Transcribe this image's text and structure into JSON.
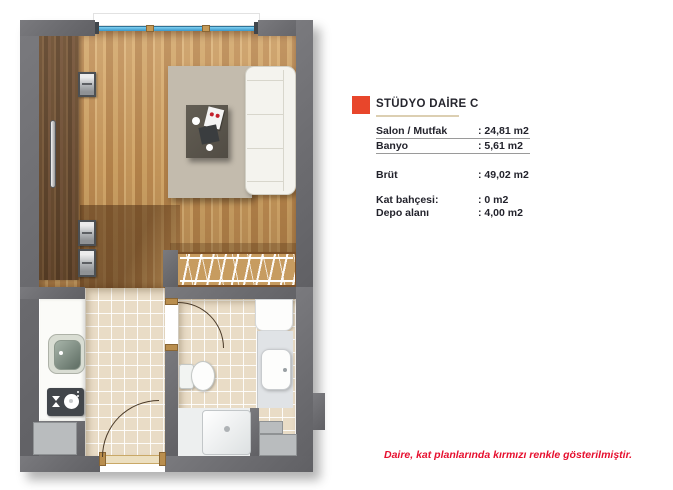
{
  "legend": {
    "marker_color": "#e8462b",
    "title": "STÜDYO DAİRE C",
    "rows": [
      {
        "label": "Salon / Mutfak",
        "value": ": 24,81 m2"
      },
      {
        "label": "Banyo",
        "value": ": 5,61 m2"
      },
      {
        "label": "Brüt",
        "value": ": 49,02 m2"
      },
      {
        "label": "Kat bahçesi:",
        "value": ": 0 m2"
      },
      {
        "label": "Depo alanı",
        "value": ": 4,00 m2"
      }
    ],
    "note": "Daire, kat planlarında kırmızı renkle gösterilmiştir."
  },
  "floorplan": {
    "colors": {
      "wall_gray": "#6b6b6f",
      "wood_light": "#c9995c",
      "wood_dark": "#6b4c2e",
      "tile_beige": "#e9dcc6",
      "rug_beige": "#c3bbad",
      "window_glass_blue": "#45a9dc",
      "accent_red": "#e8462b"
    },
    "fixtures": [
      "window",
      "wardrobe",
      "rug",
      "coffee-table",
      "sofa",
      "radiator",
      "kitchen-counter",
      "sink",
      "cooktop",
      "entry-door",
      "bathroom-door",
      "toilet",
      "washbasin",
      "shower-tray",
      "storage-niche"
    ]
  }
}
